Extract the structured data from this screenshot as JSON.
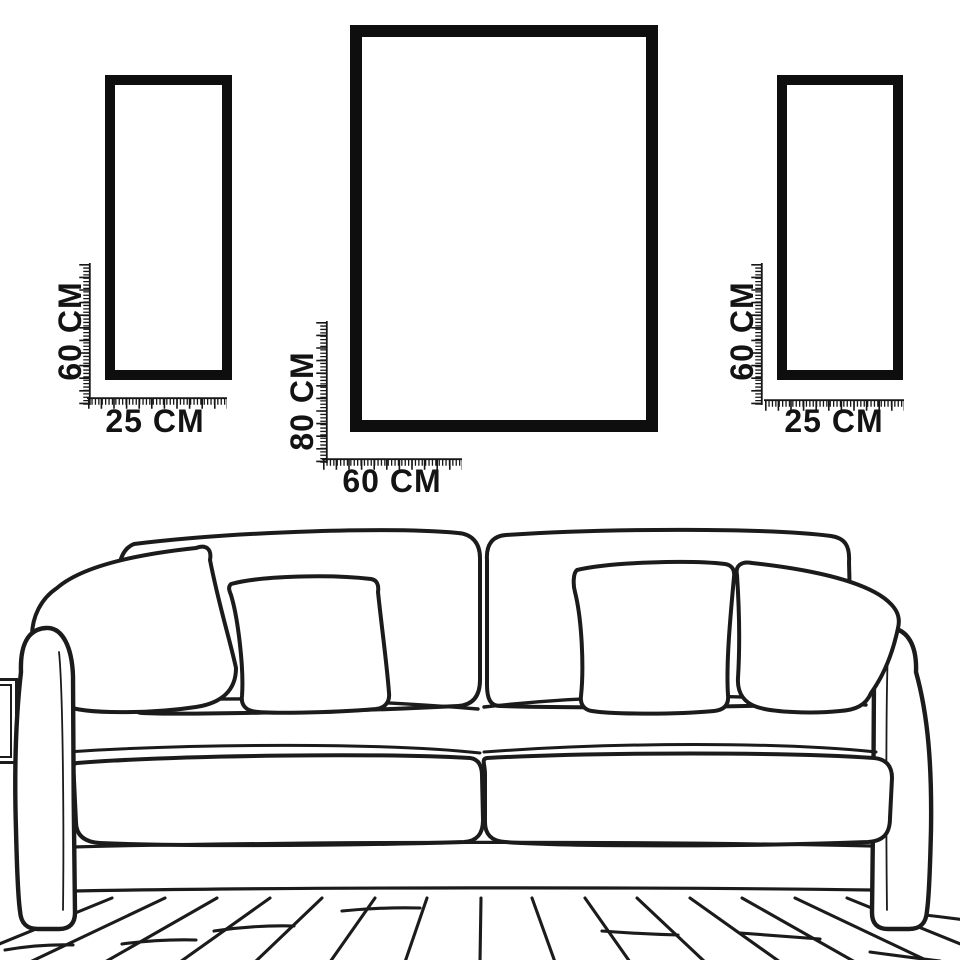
{
  "colors": {
    "ink": "#1b1b1b",
    "frame_border": "#0e0e0e",
    "background": "#ffffff"
  },
  "size_guide": {
    "frames": [
      {
        "id": "left",
        "height_label": "60 CM",
        "width_label": "25 CM"
      },
      {
        "id": "center",
        "height_label": "80 CM",
        "width_label": "60 CM"
      },
      {
        "id": "right",
        "height_label": "60 CM",
        "width_label": "25 CM"
      }
    ]
  }
}
